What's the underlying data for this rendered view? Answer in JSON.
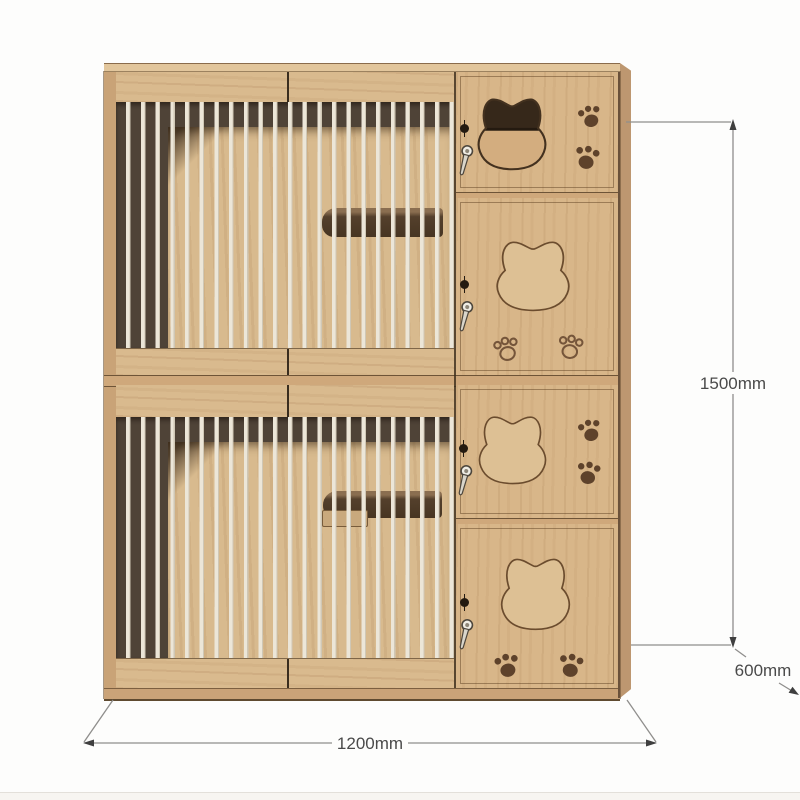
{
  "image": {
    "type": "product-dimension-diagram",
    "subject": "two-tier wooden cat cage cabinet with slatted doors, cat-head door openings and paw-print engravings"
  },
  "dimensions": {
    "height_label": "1500mm",
    "depth_label": "600mm",
    "width_label": "1200mm"
  },
  "structure": {
    "units": 2,
    "slat_doors_per_unit": 2,
    "side_compartments_per_unit": 2,
    "slat_count_per_door_row": 23,
    "hardware": [
      "barrel-knob",
      "swivel-latch"
    ],
    "decorations": [
      "cat-head-cutout",
      "cat-head-engraving",
      "paw-prints-filled",
      "paw-prints-outline"
    ],
    "interior": [
      "back-panel",
      "hanging-shelf"
    ]
  },
  "colors": {
    "wood_face": "#d8b689",
    "wood_rail": "#d9ba8e",
    "wood_side_edge": "#bd9770",
    "interior_shadow": "#4f4337",
    "interior_back": "#d8ba8e",
    "slat": "#ece6d8",
    "cutout_dark": "#36281a",
    "paw_brown": "#5e422b",
    "dimension_line": "#8f8e8c",
    "dimension_text": "#4a4a4a",
    "background": "#fdfdfc"
  }
}
